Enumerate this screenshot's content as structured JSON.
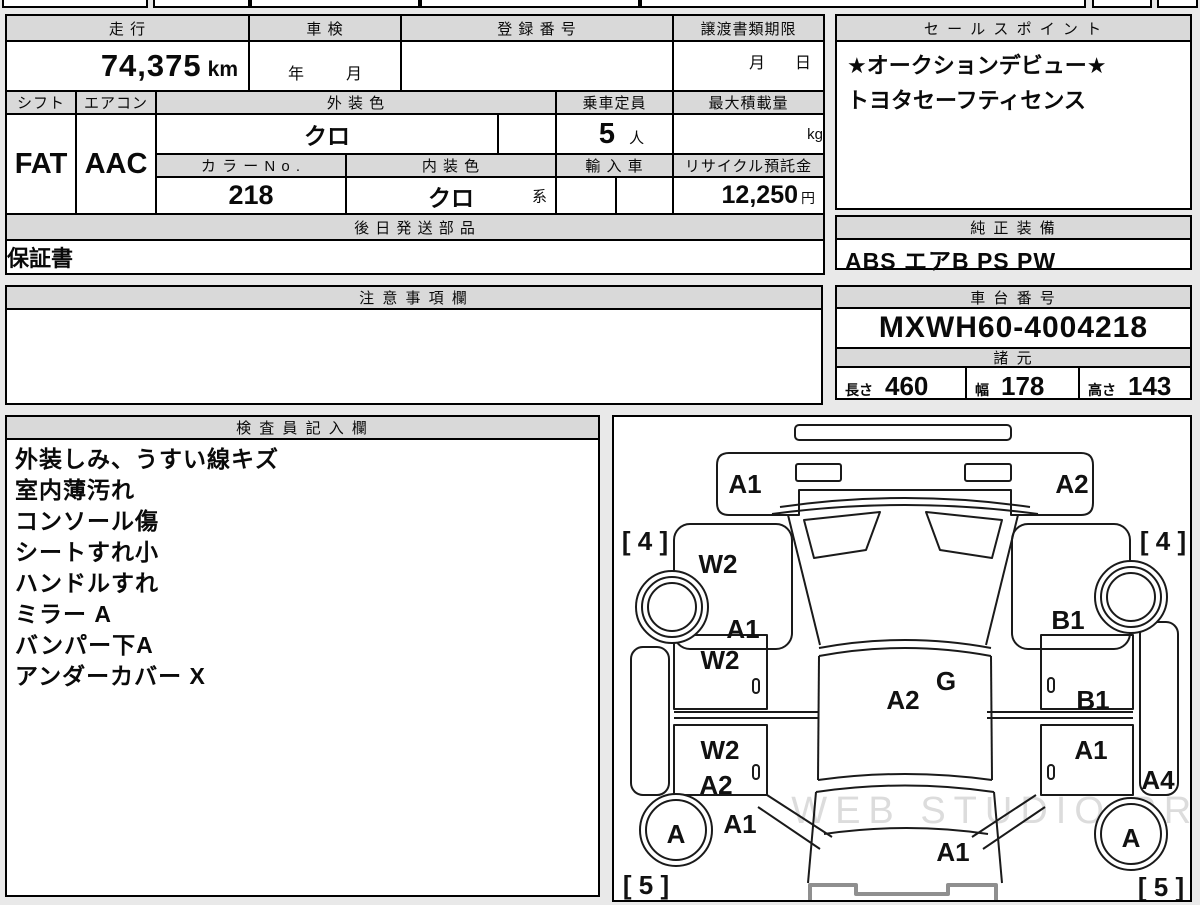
{
  "top": {
    "mileage_header": "走 行",
    "mileage_value": "74,375",
    "mileage_unit": "km",
    "shaken_header": "車 検",
    "shaken_year": "年",
    "shaken_month": "月",
    "registration_header": "登 録 番 号",
    "transfer_header": "譲渡書類期限",
    "transfer_month": "月",
    "transfer_day": "日",
    "shift_header": "シフト",
    "shift_value": "FAT",
    "aircon_header": "エアコン",
    "aircon_value": "AAC",
    "exterior_color_header": "外 装 色",
    "exterior_color_value": "クロ",
    "capacity_header": "乗車定員",
    "capacity_value": "5",
    "capacity_unit": "人",
    "max_load_header": "最大積載量",
    "max_load_unit": "kg",
    "color_no_header": "カ ラ ー N o .",
    "color_no_value": "218",
    "interior_color_header": "内 装 色",
    "interior_color_value": "クロ",
    "interior_color_suffix": "系",
    "import_header": "輸 入 車",
    "recycle_header": "リサイクル預託金",
    "recycle_value": "12,250",
    "recycle_unit": "円",
    "later_parts_header": "後 日 発 送 部 品",
    "later_parts_value": "保証書"
  },
  "sales_point": {
    "header": "セ ー ル ス ポ イ ン ト",
    "line1": "★オークションデビュー★",
    "line2": "トヨタセーフティセンス"
  },
  "genuine_equipment": {
    "header": "純 正 装 備",
    "value": "ABS エアB PS PW"
  },
  "notes": {
    "header": "注 意 事 項 欄",
    "value": ""
  },
  "chassis": {
    "header": "車 台 番 号",
    "value": "MXWH60-4004218"
  },
  "specs": {
    "header": "諸 元",
    "length_label": "長さ",
    "length_value": "460",
    "width_label": "幅",
    "width_value": "178",
    "height_label": "高さ",
    "height_value": "143"
  },
  "inspector": {
    "header": "検 査 員 記 入 欄",
    "lines": [
      "外装しみ、うすい線キズ",
      "室内薄汚れ",
      "コンソール傷",
      "シートすれ小",
      "ハンドルすれ",
      "ミラー A",
      "バンパー下A",
      "アンダーカバー X"
    ]
  },
  "diagram": {
    "watermark": "WEB STUDIO.PRO",
    "labels": [
      {
        "id": "front-bumper-left",
        "code": "A1"
      },
      {
        "id": "front-bumper-right",
        "code": "A2"
      },
      {
        "id": "bracket-front-left",
        "code": "[ 4 ]"
      },
      {
        "id": "bracket-front-right",
        "code": "[ 4 ]"
      },
      {
        "id": "front-fender-left",
        "code": "W2"
      },
      {
        "id": "front-door-area-left",
        "code": "A1"
      },
      {
        "id": "front-fender-right",
        "code": "B1"
      },
      {
        "id": "cowl-center",
        "code": "G"
      },
      {
        "id": "front-door-left",
        "code": "W2"
      },
      {
        "id": "roof-center",
        "code": "A2"
      },
      {
        "id": "front-door-right",
        "code": "B1"
      },
      {
        "id": "rear-door-left-w2",
        "code": "W2"
      },
      {
        "id": "rear-door-left-a2",
        "code": "A2"
      },
      {
        "id": "rear-door-right",
        "code": "A1"
      },
      {
        "id": "side-rear-right",
        "code": "A4"
      },
      {
        "id": "rear-quarter-left",
        "code": "A1"
      },
      {
        "id": "rear-wheel-left",
        "code": "A"
      },
      {
        "id": "rear-wheel-right",
        "code": "A"
      },
      {
        "id": "rear-hatch-center",
        "code": "A1"
      },
      {
        "id": "bracket-rear-left",
        "code": "[ 5 ]"
      },
      {
        "id": "bracket-rear-right",
        "code": "[ 5 ]"
      }
    ]
  },
  "colors": {
    "header_bg": "#d9d9d9",
    "border": "#000000",
    "page_bg": "#e9e9e9",
    "watermark": "#dcdcdc"
  }
}
